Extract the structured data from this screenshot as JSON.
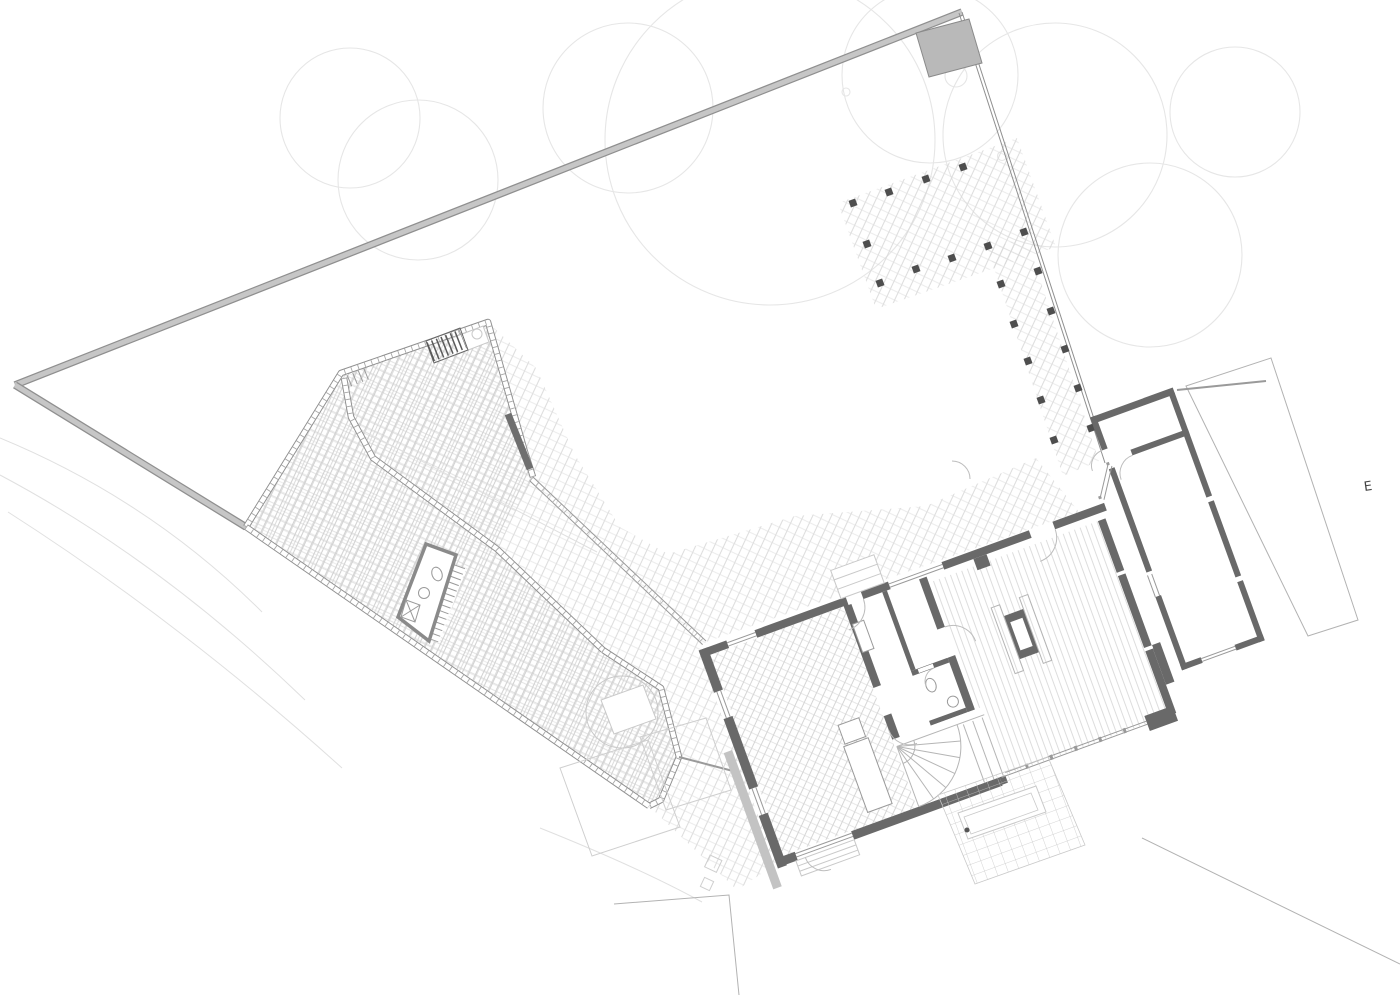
{
  "plan": {
    "name": "architectural-site-and-ground-floor-plan",
    "orientation_label": "E",
    "colors": {
      "wall": "#696969",
      "wall_light": "#c3c3c3",
      "boundary_fill": "#c6c6c6",
      "boundary_edge": "#8f8f8f",
      "masonry_edge": "#8f8f8f",
      "masonry_tick": "#a8a8a8",
      "paving": "#d9d9d9",
      "court_paving": "#cccccc",
      "floor_line": "#d5d5d5",
      "tile_line": "#c8c8c8",
      "post": "#4e4e4e",
      "tree": "#e6e6e6",
      "contour": "#e0e0e0",
      "neighbor": "#b2b2b2",
      "glass": "#9a9a9a",
      "thin_outline": "#c9c9c9",
      "fixture": "#9a9a9a",
      "ink": "#444444",
      "shed": "#cfcfcf"
    }
  }
}
